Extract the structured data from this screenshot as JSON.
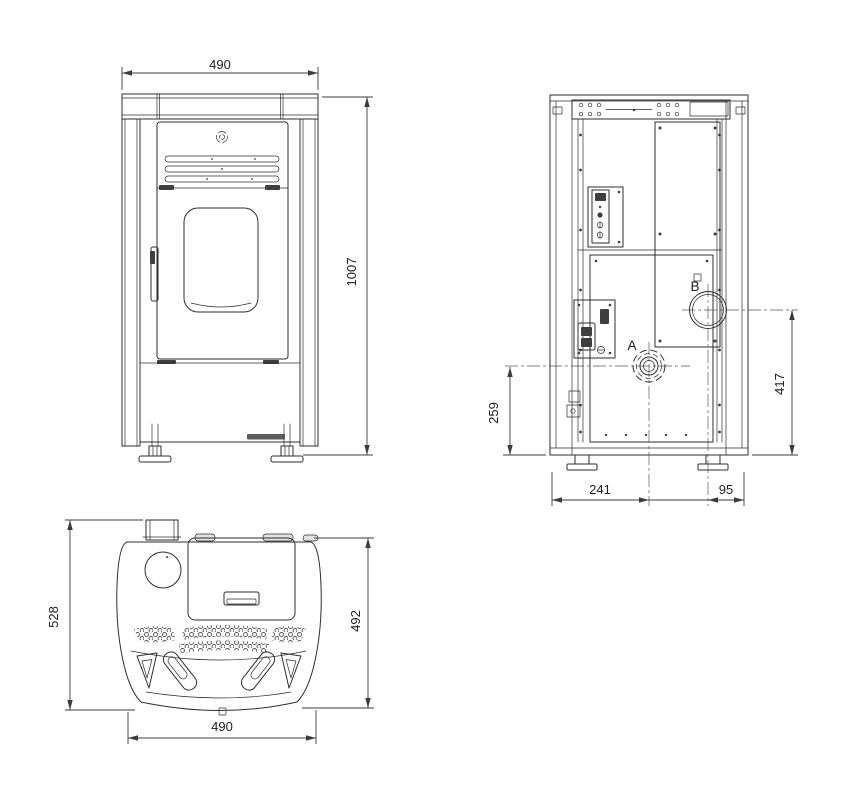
{
  "front_view": {
    "width": "490",
    "height": "1007"
  },
  "rear_view": {
    "label_a": "A",
    "label_b": "B",
    "dim_a_from_floor": "259",
    "dim_b_from_floor": "417",
    "dim_a_from_left": "241",
    "dim_b_from_right": "95"
  },
  "top_view": {
    "depth_overall": "528",
    "depth_body": "492",
    "width": "490"
  },
  "colors": {
    "line": "#2e2e2e",
    "dim": "#3c3c3c",
    "dark_fill": "#3f3f3f",
    "background": "#ffffff"
  }
}
